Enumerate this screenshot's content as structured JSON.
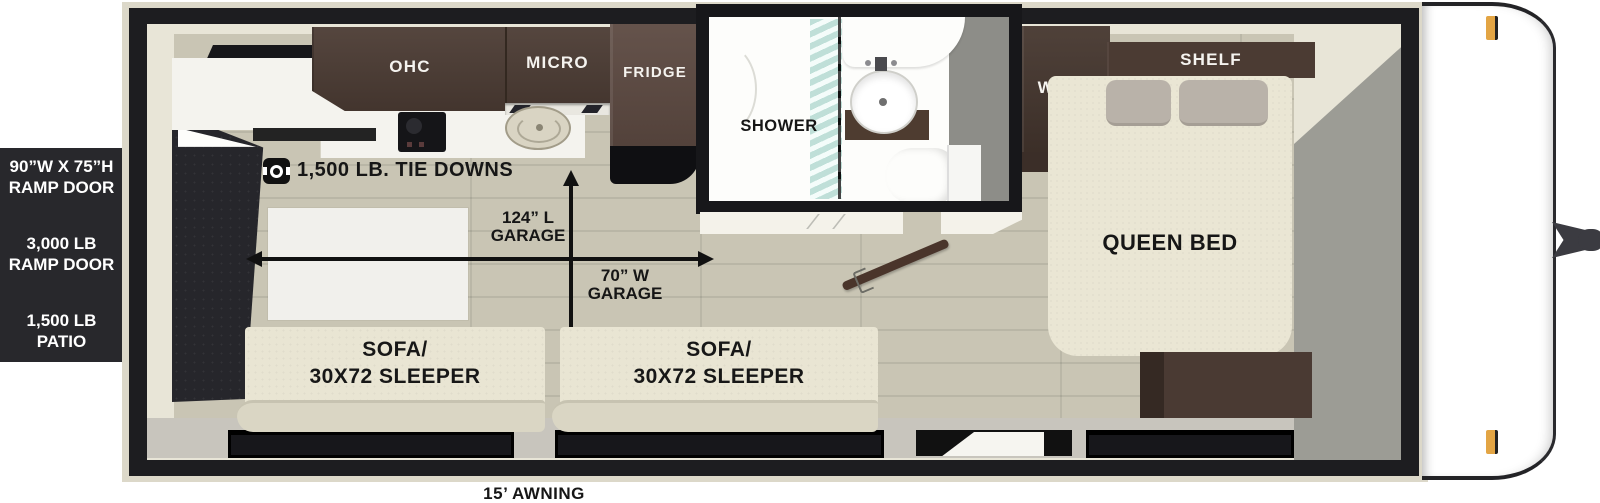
{
  "title": "Travel trailer floorplan - rear ramp toy hauler",
  "colors": {
    "floor": "#c9c5b4",
    "wall_black": "#1d1d20",
    "exterior_sheath": "#dcd8c9",
    "interior_cream": "#e8e5d7",
    "cabinet_wood": "#4c3c34",
    "fridge_wood": "#5b4840",
    "sofa_cream": "#e9e5d3",
    "sofa_seat": "#dad6c4",
    "bedroom_wall_gray": "#9c9c95",
    "info_panel_bg": "#28282c",
    "marker_amber": "#e3a544",
    "shower_glass_teal": "#96cbc0"
  },
  "ramp_panel": {
    "ramp_size_line1": "90”W X 75”H",
    "ramp_size_line2": "RAMP DOOR",
    "ramp_weight_line1": "3,000 LB",
    "ramp_weight_line2": "RAMP DOOR",
    "patio_line1": "1,500 LB",
    "patio_line2": "PATIO"
  },
  "kitchen": {
    "ohc": "OHC",
    "micro": "MICRO",
    "fridge": "FRIDGE"
  },
  "garage": {
    "tie_downs": "1,500 LB. TIE DOWNS",
    "length": {
      "line1": "124” L",
      "line2": "GARAGE"
    },
    "width": {
      "line1": "70” W",
      "line2": "GARAGE"
    }
  },
  "bathroom": {
    "shower": "SHOWER"
  },
  "bedroom": {
    "ward": "WARD",
    "shelf": "SHELF",
    "queen_bed": "QUEEN BED"
  },
  "sofas": {
    "line1": "SOFA/",
    "line2": "30X72 SLEEPER"
  },
  "awning": "15’ AWNING"
}
